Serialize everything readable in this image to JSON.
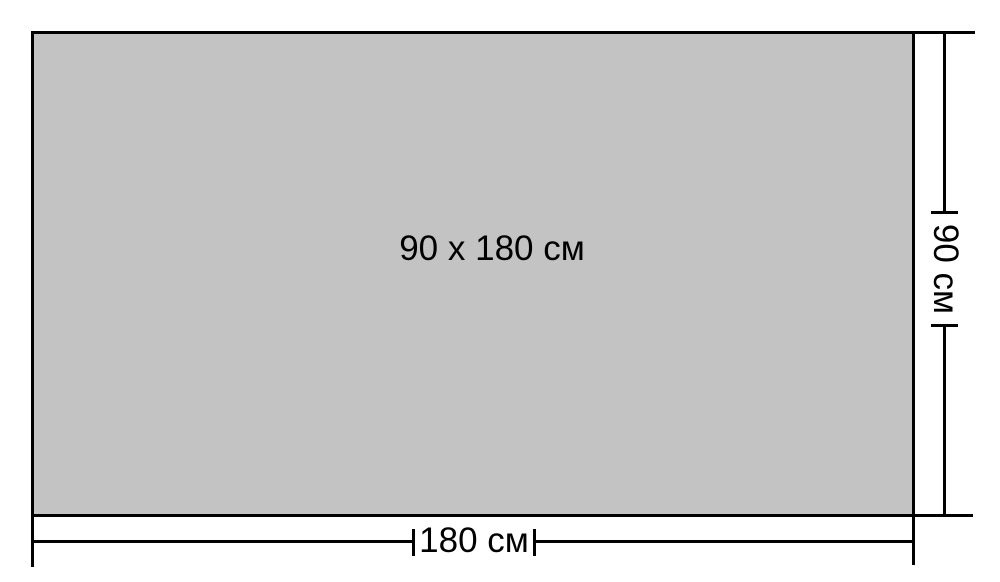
{
  "diagram": {
    "panel_label": "90 x 180 см",
    "width_dimension": {
      "label": "180 см",
      "value_cm": 180
    },
    "height_dimension": {
      "label": "90 см",
      "value_cm": 90
    },
    "colors": {
      "panel_fill": "#c3c3c3",
      "line": "#000000",
      "background": "#ffffff"
    }
  }
}
